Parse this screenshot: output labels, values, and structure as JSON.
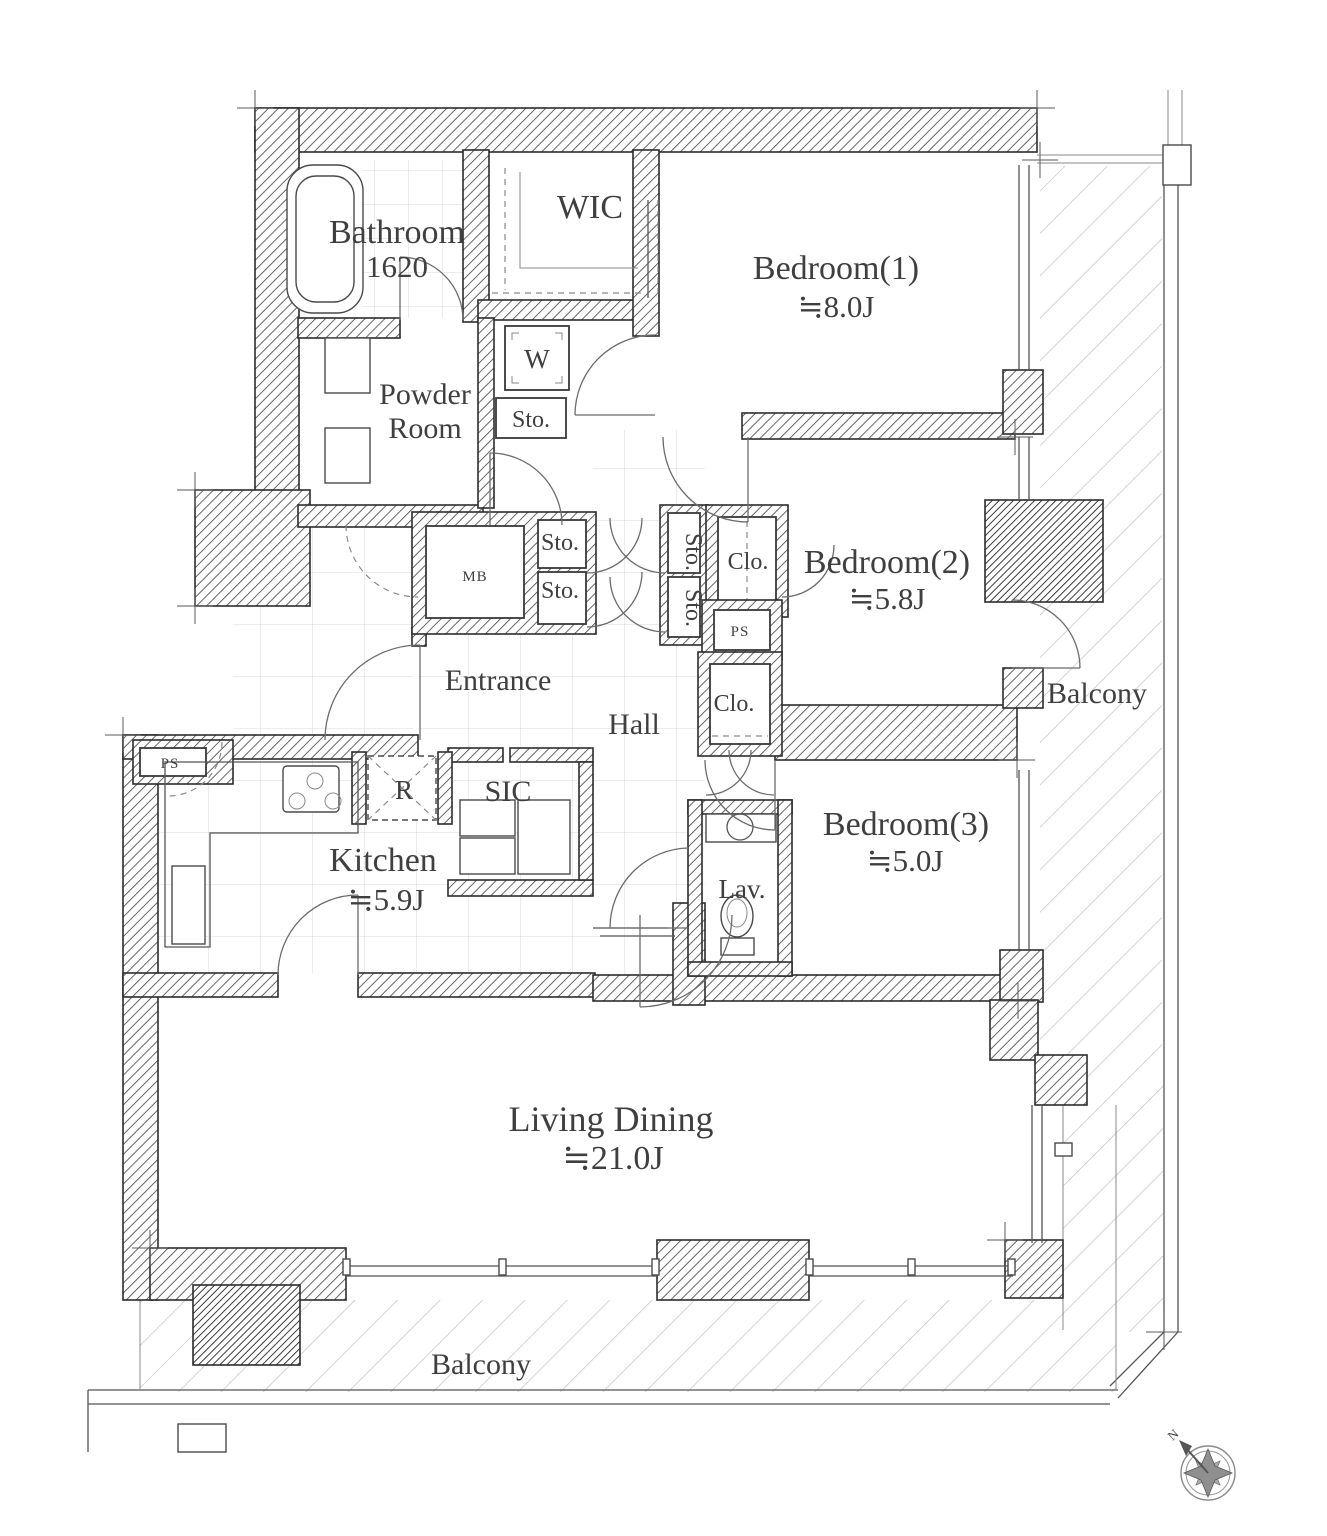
{
  "floorplan": {
    "rooms": {
      "bathroom": {
        "name": "Bathroom",
        "size": "1620"
      },
      "wic": {
        "name": "WIC"
      },
      "bedroom1": {
        "name": "Bedroom(1)",
        "area": "≒8.0J"
      },
      "powder_room": {
        "line1": "Powder",
        "line2": "Room"
      },
      "bedroom2": {
        "name": "Bedroom(2)",
        "area": "≒5.8J"
      },
      "bedroom3": {
        "name": "Bedroom(3)",
        "area": "≒5.0J"
      },
      "kitchen": {
        "name": "Kitchen",
        "area": "≒5.9J"
      },
      "living_dining": {
        "name": "Living Dining",
        "area": "≒21.0J"
      },
      "entrance": {
        "name": "Entrance"
      },
      "hall": {
        "name": "Hall"
      },
      "sic": {
        "name": "SIC"
      },
      "lavatory": {
        "name": "Lav."
      },
      "balcony_right": {
        "name": "Balcony"
      },
      "balcony_bottom": {
        "name": "Balcony"
      }
    },
    "fixtures": {
      "washer": "W",
      "refrigerator": "R",
      "meter_box": "MB",
      "ps_hall": "PS",
      "ps_kitchen": "PS",
      "sto_powder": "Sto.",
      "sto_hall_1": "Sto.",
      "sto_hall_2": "Sto.",
      "sto_side_1": "Sto.",
      "sto_side_2": "Sto.",
      "clo_bedroom2": "Clo.",
      "clo_bedroom3": "Clo."
    },
    "compass": {
      "north": "N"
    },
    "colors": {
      "ink": "#3f3f3f",
      "wall_hatch": "#4a4a4a",
      "balcony_hatch": "#c2c2c2",
      "paper": "#ffffff"
    }
  }
}
